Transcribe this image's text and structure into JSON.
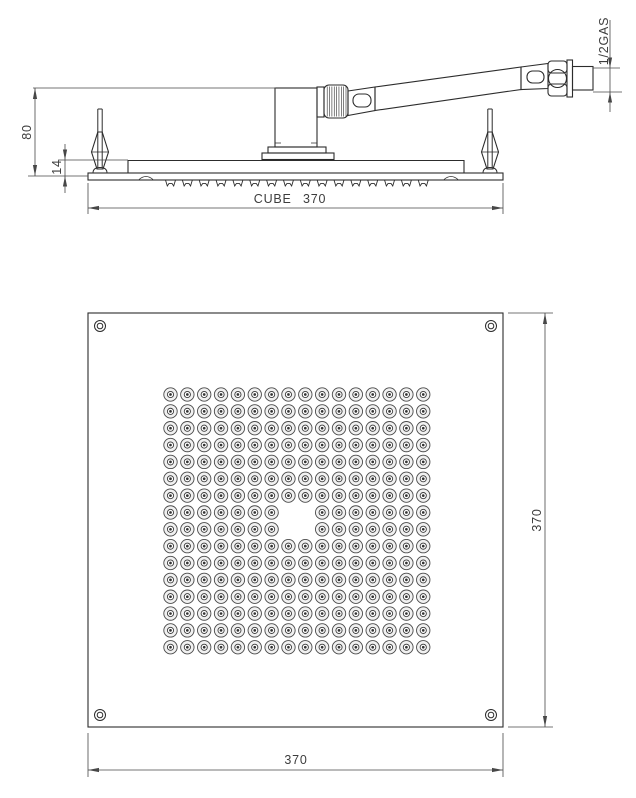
{
  "drawing": {
    "labels": {
      "side_height": "80",
      "side_thickness": "14",
      "side_width": "CUBE 370",
      "side_thread": "1/2GAS",
      "plan_side_right": "370",
      "plan_side_bottom": "370"
    },
    "plan_view": {
      "nozzle_grid": {
        "cols": 16,
        "rows": 16,
        "start_x": 170.5,
        "start_y": 394.5,
        "spacing": 16.85,
        "missing_center_cols": [
          7,
          8
        ],
        "missing_center_rows": [
          7,
          8
        ],
        "outer_r": 6.7,
        "mid_r": 3.1,
        "dot_r": 1.35
      },
      "corner_screws": {
        "positions": [
          [
            100,
            326
          ],
          [
            491,
            326
          ],
          [
            100,
            715
          ],
          [
            491,
            715
          ]
        ],
        "outer_r": 5.5,
        "inner_r": 2.8
      }
    },
    "side_view": {
      "nozzle_row": {
        "count": 16,
        "start_x": 170.5,
        "spacing": 16.85,
        "top_y": 180,
        "depth": 6
      },
      "mount_pins_x": [
        100,
        490
      ],
      "knurl": {
        "x0": 327.2,
        "count": 9,
        "step": 2.35,
        "y1": 86.5,
        "y2": 116.5
      }
    },
    "colors": {
      "line": "#2c2c2c",
      "dim": "#474747",
      "text": "#3d3d3d",
      "nozzle_fill": "#f1f1f1",
      "background": "#ffffff"
    }
  }
}
